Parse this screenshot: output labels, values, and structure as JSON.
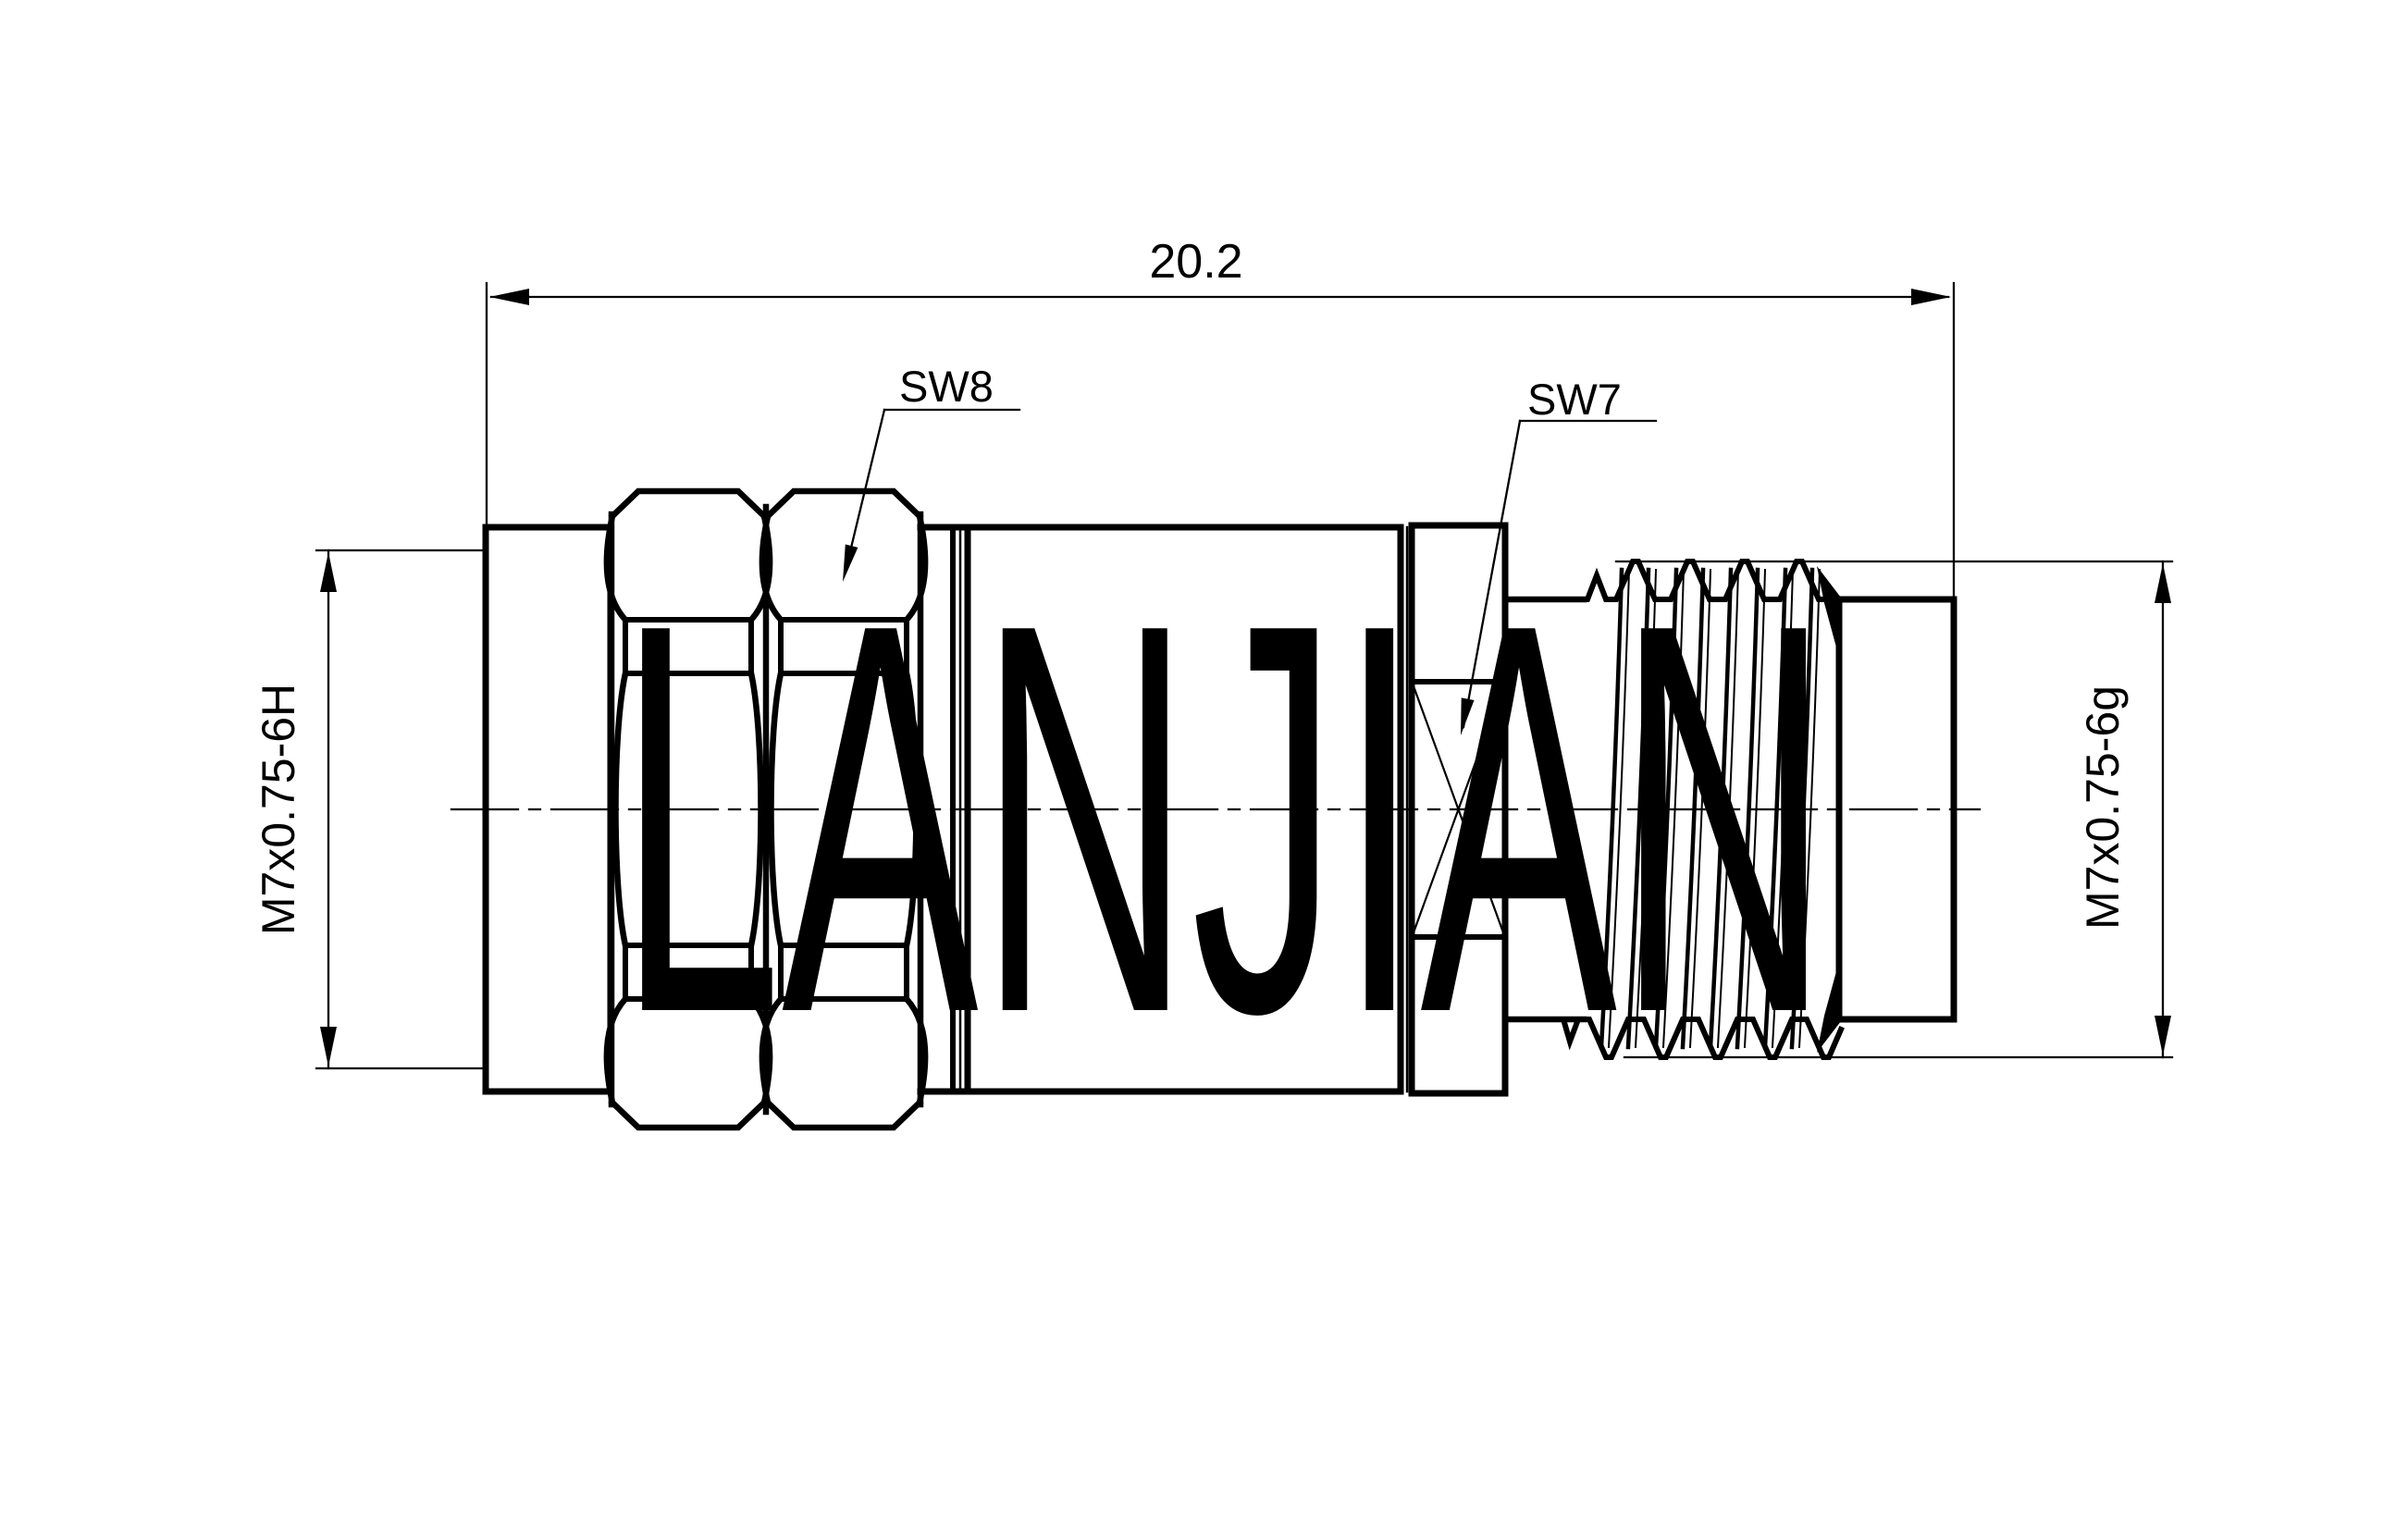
{
  "drawing": {
    "type": "technical-drawing",
    "watermark": "LANJIAN",
    "dimensions": {
      "overall_length": "20.2",
      "left_thread": "M7x0.75-6H",
      "right_thread": "M7x0.75-6g"
    },
    "callouts": {
      "front_hex": "SW8",
      "rear_hex": "SW7"
    },
    "colors": {
      "line": "#000000",
      "background": "#ffffff",
      "watermark": "#d4d4d4"
    }
  }
}
